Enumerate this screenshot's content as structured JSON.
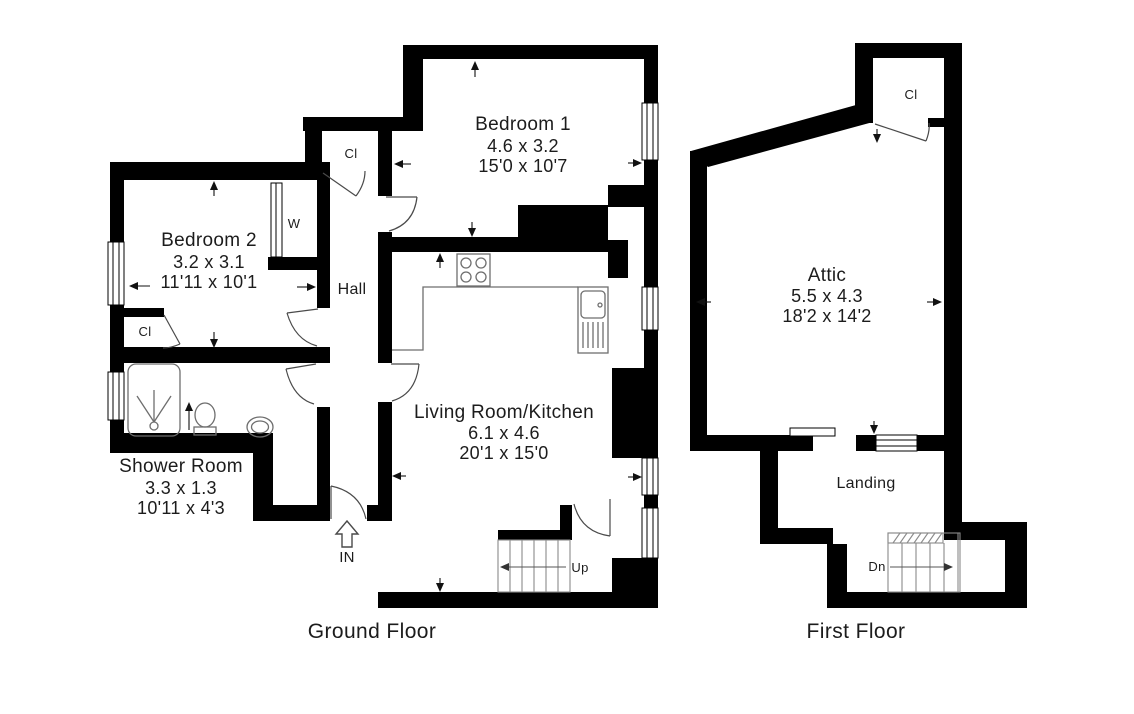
{
  "ground": {
    "floor_label": "Ground Floor",
    "bedroom1": {
      "name": "Bedroom 1",
      "metric": "4.6 x 3.2",
      "imperial": "15'0 x 10'7"
    },
    "bedroom2": {
      "name": "Bedroom 2",
      "metric": "3.2 x 3.1",
      "imperial": "11'11 x 10'1"
    },
    "living_kitchen": {
      "name": "Living Room/Kitchen",
      "metric": "6.1 x 4.6",
      "imperial": "20'1 x 15'0"
    },
    "shower_room": {
      "name": "Shower Room",
      "metric": "3.3 x 1.3",
      "imperial": "10'11 x 4'3"
    },
    "hall": {
      "name": "Hall"
    },
    "hall_closet": "Cl",
    "bedroom2_closet": "Cl",
    "wardrobe": "W",
    "stairs_up": "Up",
    "entrance": "IN"
  },
  "first": {
    "floor_label": "First Floor",
    "attic": {
      "name": "Attic",
      "metric": "5.5 x 4.3",
      "imperial": "18'2 x 14'2"
    },
    "landing": {
      "name": "Landing"
    },
    "closet": "Cl",
    "stairs_down": "Dn"
  },
  "colors": {
    "wall": "#000000",
    "background": "#ffffff",
    "fixture_line": "#6e6e6e",
    "door_line": "#4a4a4a",
    "text": "#1c1c1c"
  }
}
